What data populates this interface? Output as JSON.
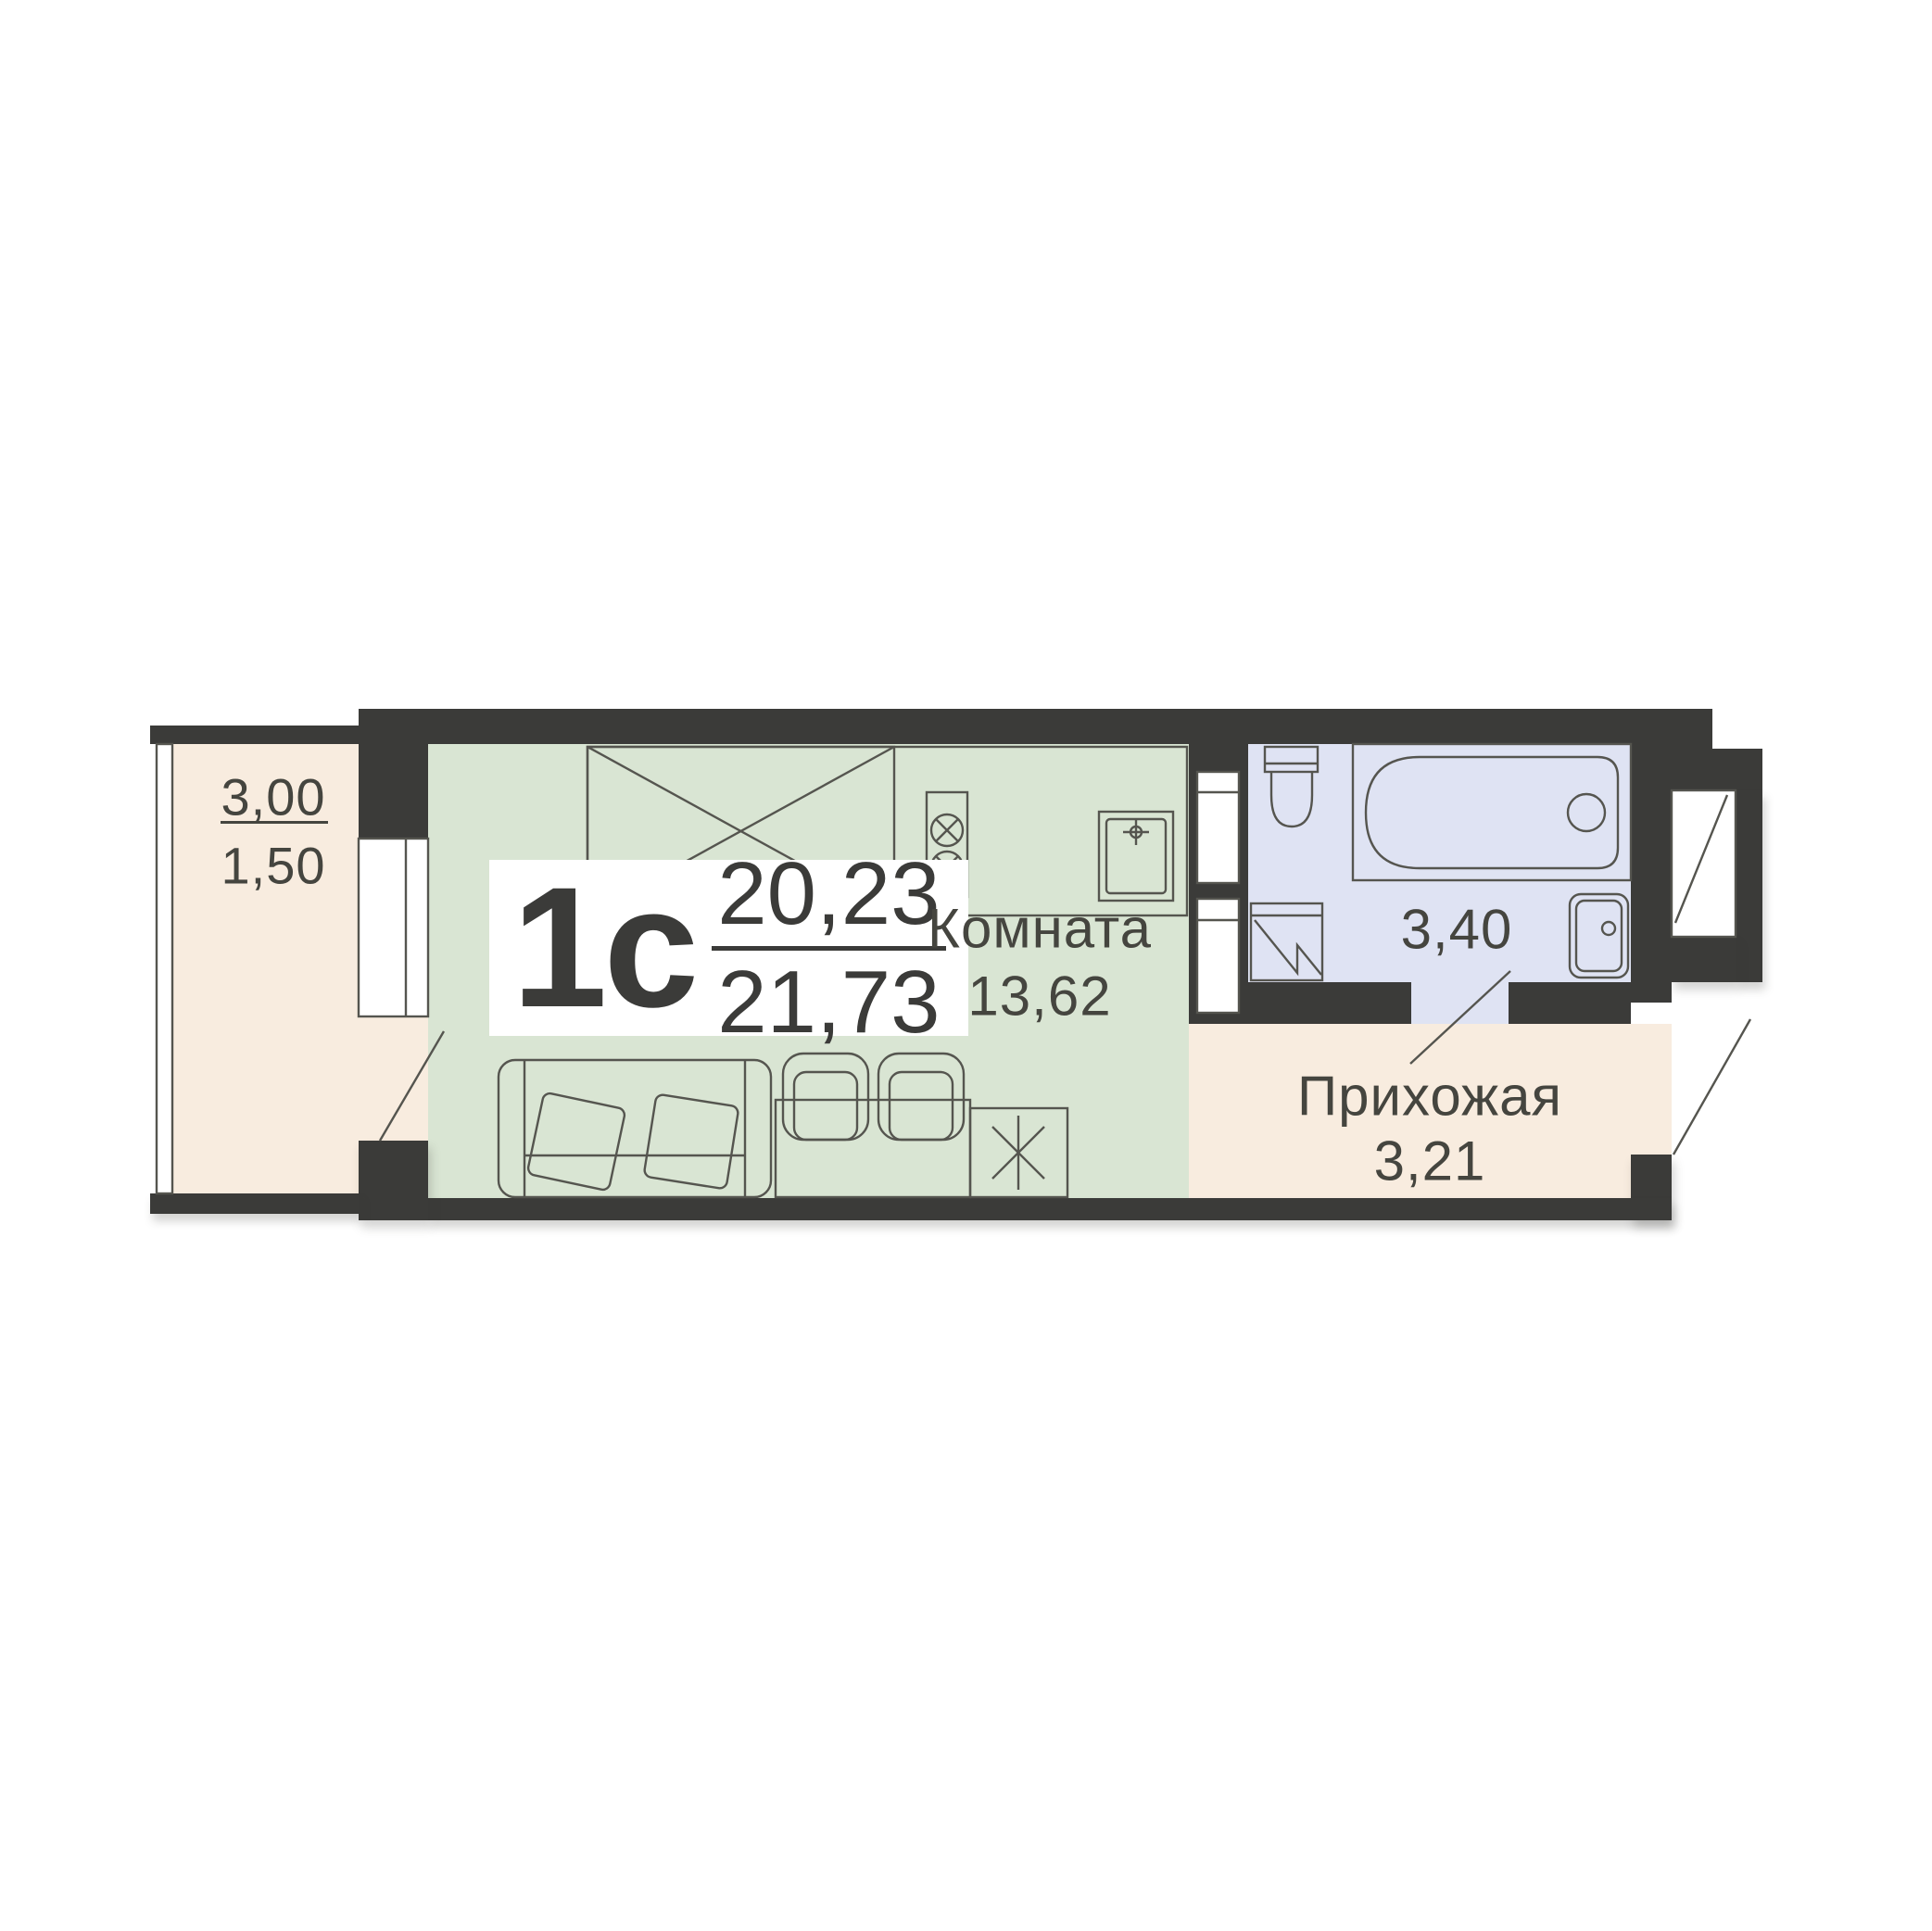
{
  "title": "apartment-floor-plan",
  "badge": {
    "type": "1с",
    "area_total": "20,23",
    "area_living": "21,73"
  },
  "balcony": {
    "area_over": "3,00",
    "area_under": "1,50"
  },
  "room": {
    "name": "Комната",
    "area": "13,62"
  },
  "bathroom": {
    "area": "3,40"
  },
  "hallway": {
    "name": "Прихожая",
    "area": "3,21"
  },
  "colors": {
    "wall": "#3b3b39",
    "living": "#d9e5d3",
    "wet": "#dfe3f3",
    "warm": "#f8ecdf",
    "line": "#55554f",
    "text": "#45453f",
    "bg": "#ffffff"
  }
}
